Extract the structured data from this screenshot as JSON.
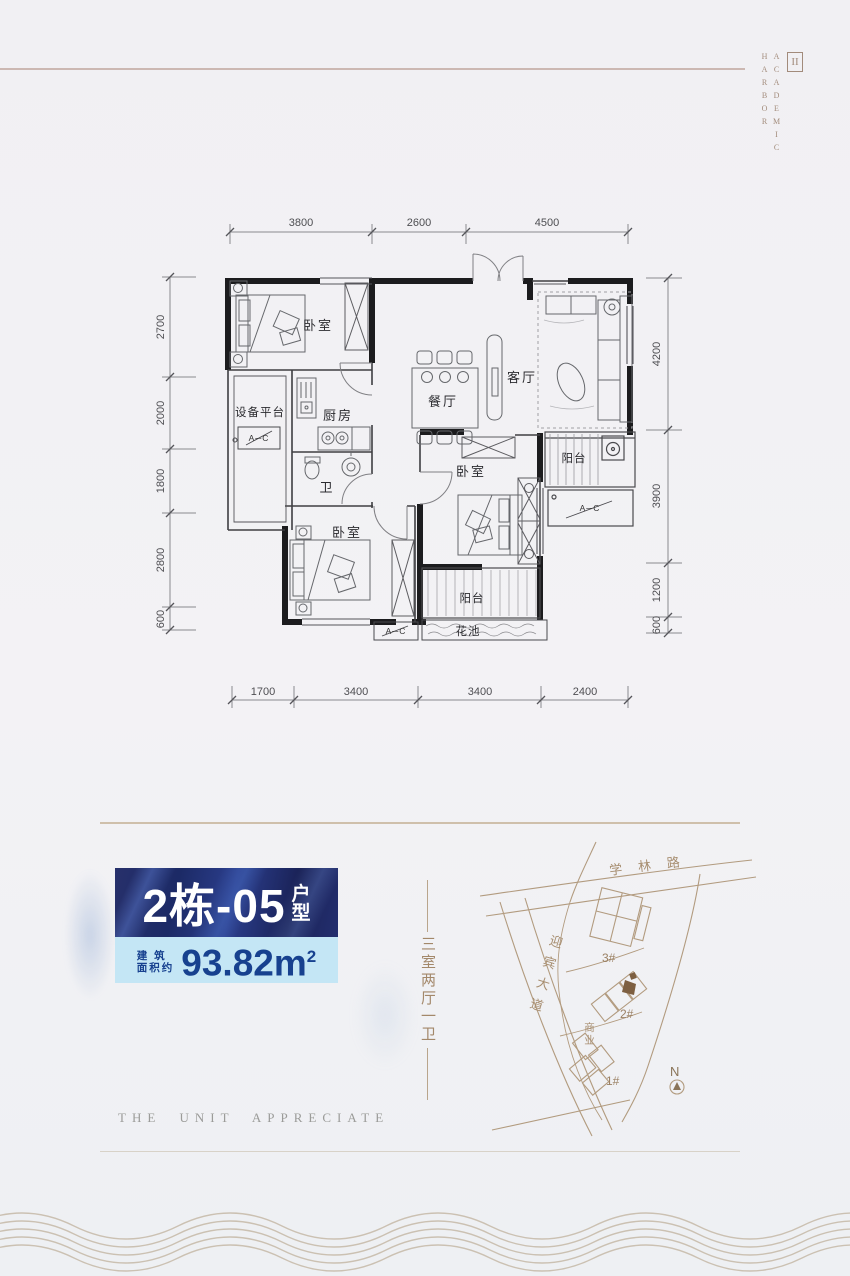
{
  "brand": {
    "line1": "ACADEMIC",
    "line2": "HARBOR",
    "logo": "II"
  },
  "floorplan": {
    "dims": {
      "top": [
        "3800",
        "2600",
        "4500"
      ],
      "bottom": [
        "1700",
        "3400",
        "3400",
        "2400"
      ],
      "left": [
        "2700",
        "2000",
        "1800",
        "2800",
        "600"
      ],
      "right": [
        "4200",
        "3900",
        "1200",
        "600"
      ]
    },
    "rooms": {
      "bedroom": "卧室",
      "equipment_platform": "设备平台",
      "kitchen": "厨房",
      "dining": "餐厅",
      "living": "客厅",
      "bath": "卫",
      "balcony": "阳台",
      "flower_bed": "花池",
      "ac_unit": "A─C"
    }
  },
  "unit_card": {
    "unit_number": "2栋-05",
    "unit_suffix_top": "户",
    "unit_suffix_bottom": "型",
    "area_prefix_line1": "建 筑",
    "area_prefix_line2": "面积约",
    "area_value": "93.82m",
    "area_exponent": "2"
  },
  "tagline": {
    "text_vertical": "三室两厅一卫"
  },
  "site_map": {
    "road_top": "学林路",
    "road_left": "迎宾大道",
    "building_3": "3#",
    "building_2": "2#",
    "building_1": "1#",
    "commercial": "商业",
    "north": "N"
  },
  "footer": {
    "caption_en": "THE UNIT APPRECIATE"
  }
}
